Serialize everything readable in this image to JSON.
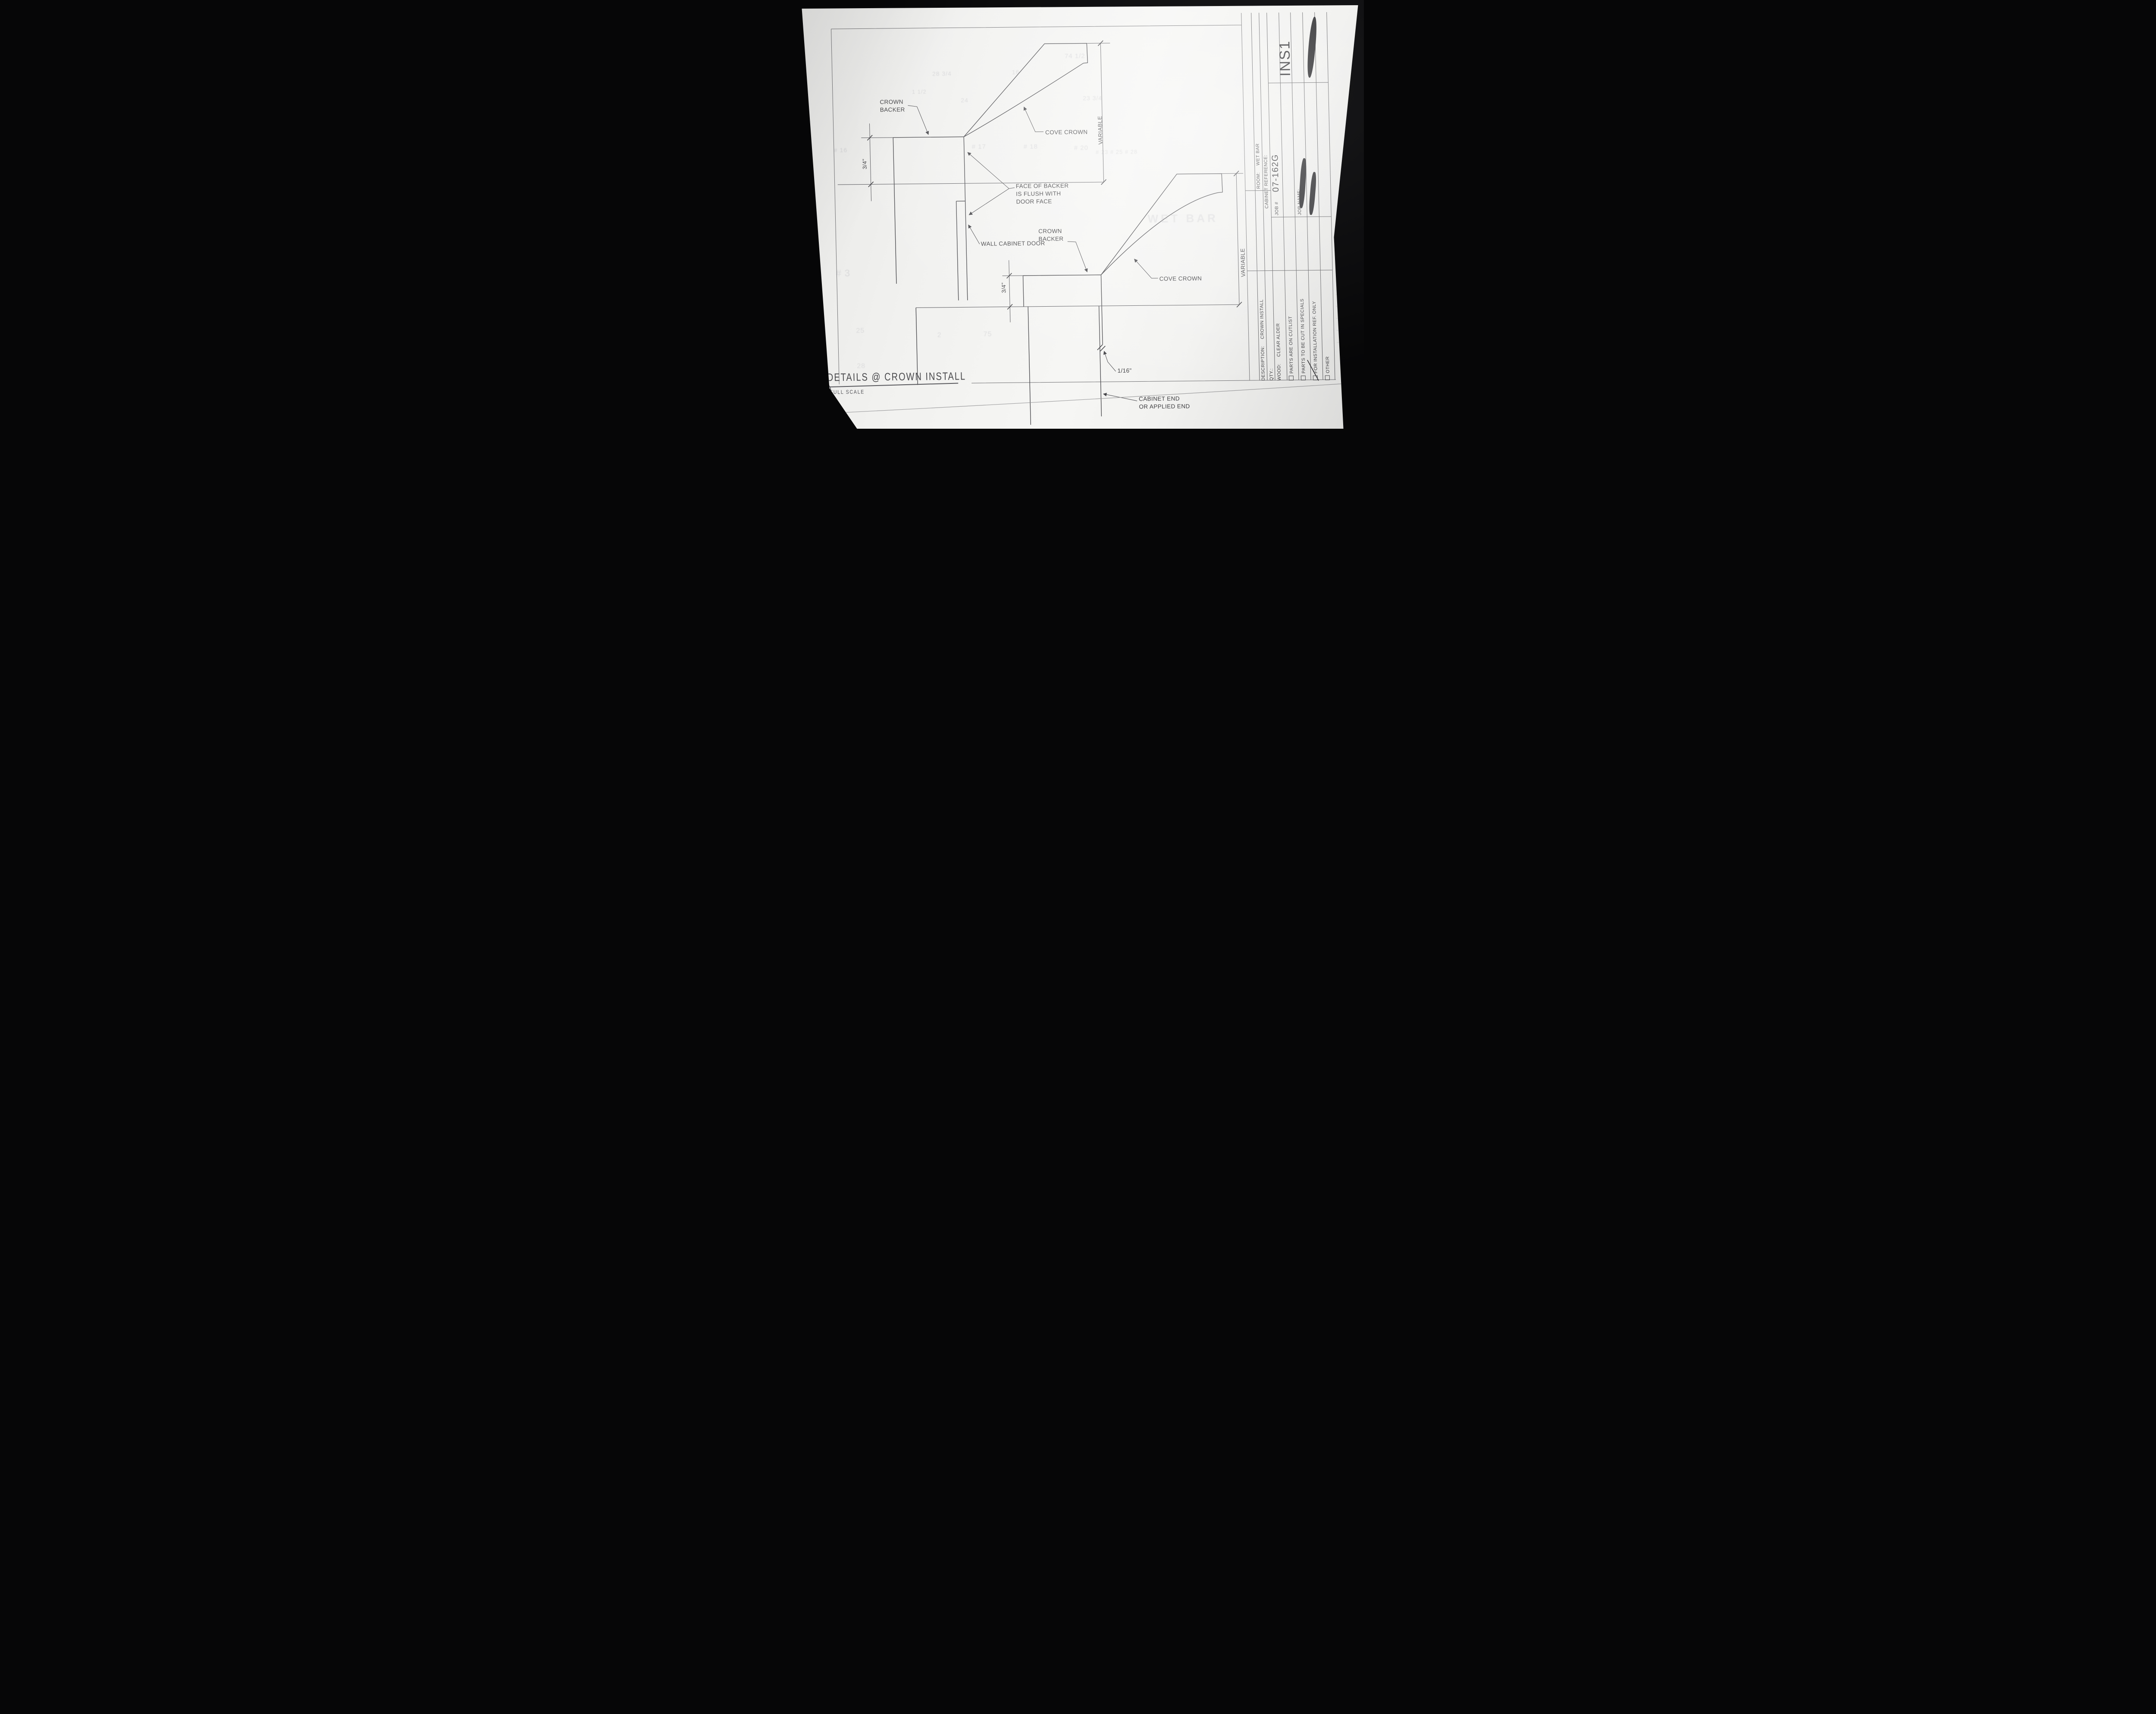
{
  "sheet": {
    "code": "INS1",
    "detail_number": "1",
    "title": "DETAILS @ CROWN INSTALL",
    "scale_label": "FULL SCALE"
  },
  "title_block": {
    "room_label": "ROOM:",
    "room_value": "WET BAR",
    "cabinet_reference_label": "CABINET REFERENCE:",
    "job_number_label": "JOB #",
    "job_number_value": "07-162G",
    "job_name_label": "JOB NAME:",
    "description_label": "DESCRIPTION:",
    "description_value": "CROWN INSTALL",
    "qty_label": "QTY.:",
    "wood_label": "WOOD:",
    "wood_value": "CLEAR ALDER",
    "checkboxes": [
      {
        "label": "PARTS ARE ON CUTLIST",
        "checked": false
      },
      {
        "label": "PARTS TO BE CUT IN SPECIALS",
        "checked": false
      },
      {
        "label": "FOR INSTALLATION REF. ONLY",
        "checked": true
      },
      {
        "label": "OTHER",
        "checked": false
      }
    ]
  },
  "upper_detail": {
    "crown_backer_line1": "CROWN",
    "crown_backer_line2": "BACKER",
    "cove_crown": "COVE CROWN",
    "variable_dim": "VARIABLE",
    "thickness_dim": "3/4\"",
    "flush_note_line1": "FACE OF BACKER",
    "flush_note_line2": "IS FLUSH WITH",
    "flush_note_line3": "DOOR FACE",
    "door_label": "WALL CABINET DOOR"
  },
  "lower_detail": {
    "crown_backer_line1": "CROWN",
    "crown_backer_line2": "BACKER",
    "cove_crown": "COVE CROWN",
    "variable_dim": "VARIABLE",
    "thickness_dim": "3/4\"",
    "gap_dim": "1/16\"",
    "end_note_line1": "CABINET END",
    "end_note_line2": "OR APPLIED END"
  },
  "ghost_bleed_text": {
    "g1": "74 1/2",
    "g2": "28 3/4",
    "g3": "16",
    "g4": "24",
    "g5": "23 3/4",
    "g6": "1 1/2",
    "g7": "# 17",
    "g8": "# 18",
    "g9": "# 20",
    "g10": "# 23 # 25 # 28",
    "g11": "WET BAR",
    "g12": "# 3",
    "g13": "25",
    "g14": "2",
    "g15": "75",
    "g16": "# 16",
    "g17": "28"
  }
}
